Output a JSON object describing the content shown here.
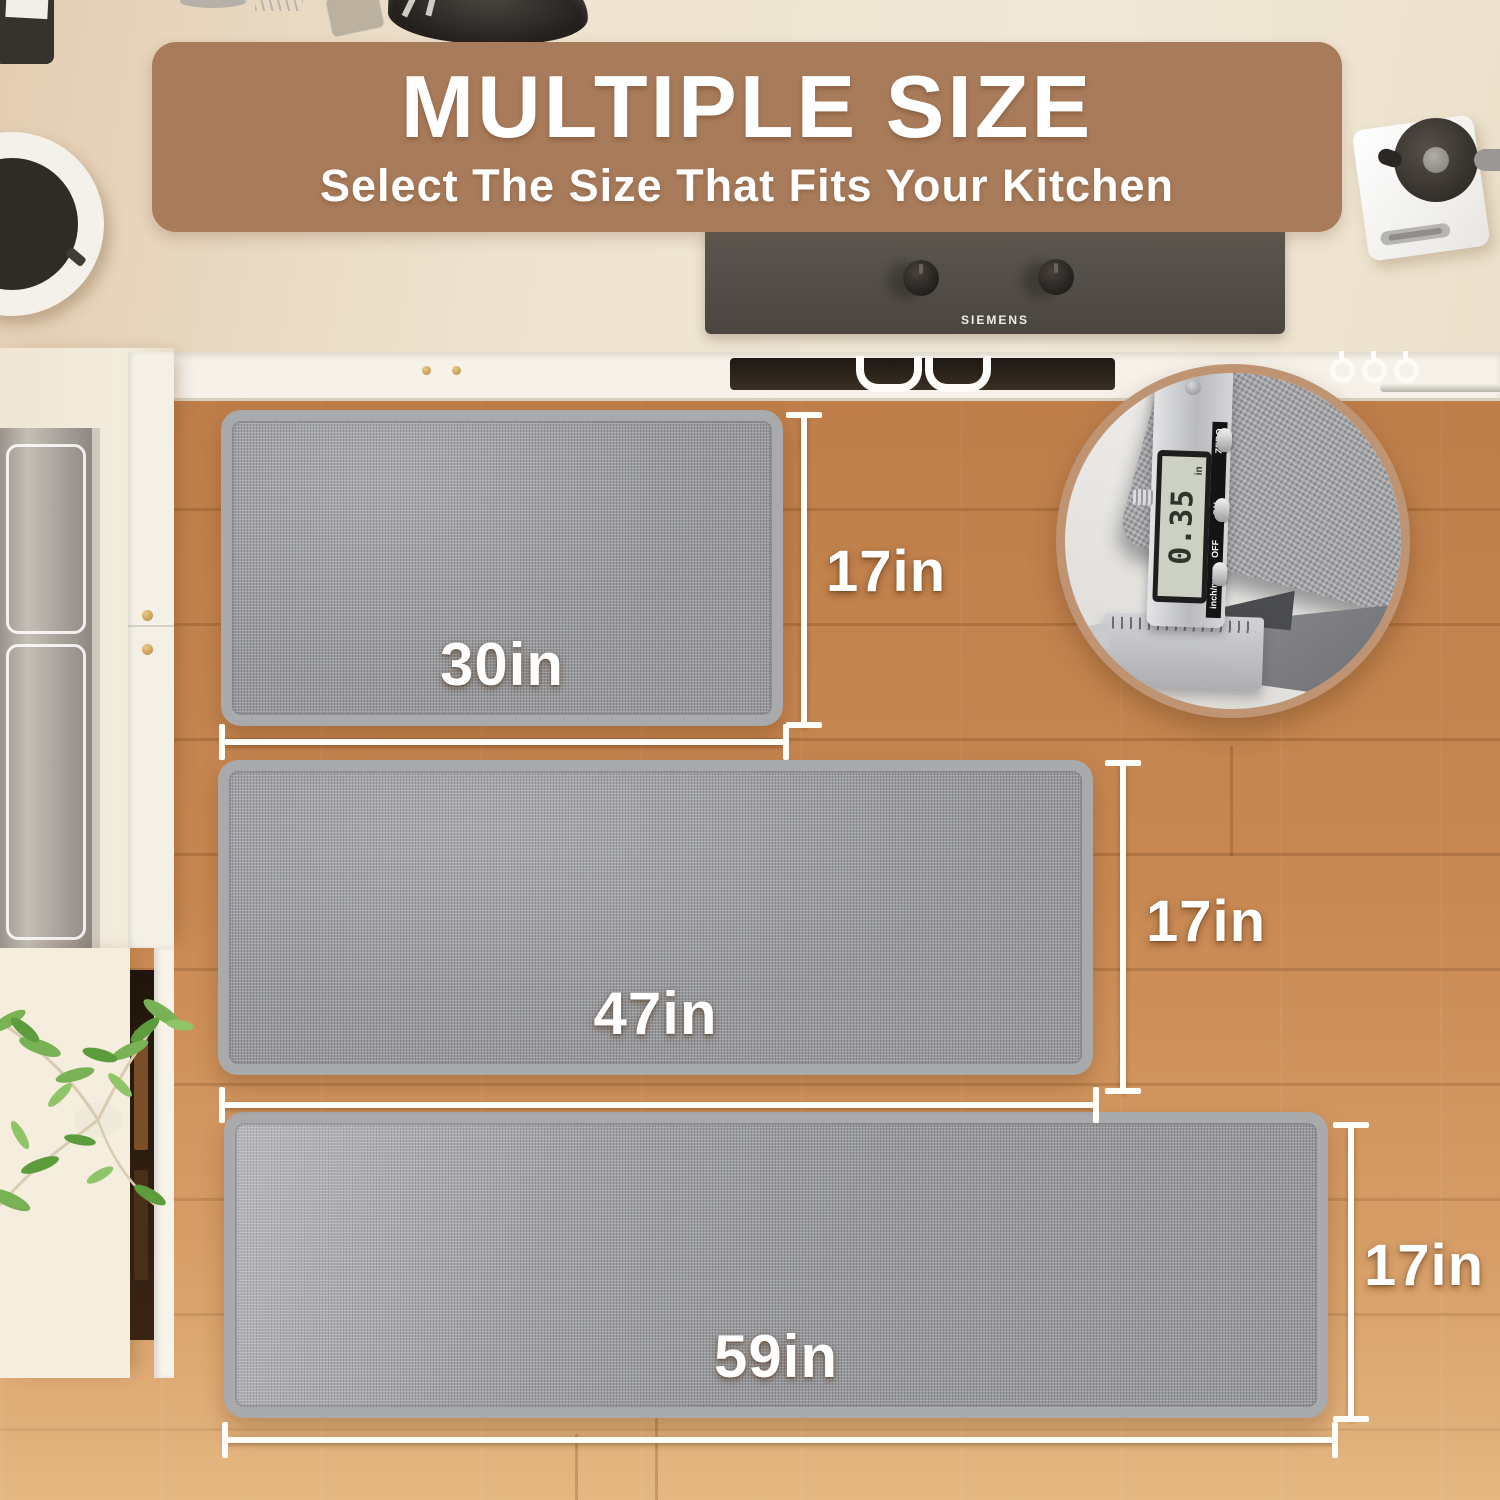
{
  "banner": {
    "title": "MULTIPLE SIZE",
    "subtitle": "Select The Size That Fits Your Kitchen",
    "bg_color": "#a87b5a",
    "text_color": "#ffffff"
  },
  "mats": [
    {
      "width_label": "30in",
      "height_label": "17in"
    },
    {
      "width_label": "47in",
      "height_label": "17in"
    },
    {
      "width_label": "59in",
      "height_label": "17in"
    }
  ],
  "inset": {
    "display_value": "0.35",
    "display_unit": "in",
    "button_labels": [
      "ZERO",
      "ON",
      "OFF"
    ],
    "mode_label": "inch/mm"
  },
  "appliances": {
    "stove_brand": "SIEMENS"
  },
  "colors": {
    "banner_bg": "#a87b5a",
    "floor_wood": "#d0905a",
    "mat_fill": "#97989b",
    "mat_border": "#a9aaac",
    "dimension_line": "#fffef8",
    "counter": "#eee3cf",
    "inset_ring": "#bf9473"
  }
}
